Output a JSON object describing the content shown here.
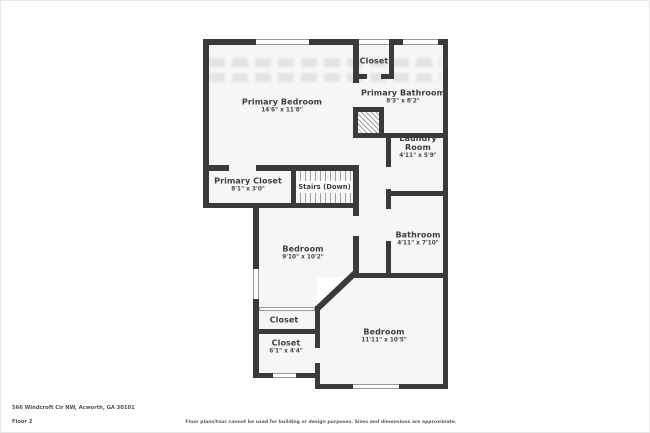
{
  "address_line": "566 Windcroft Cir NW, Acworth, GA 30101",
  "floor_label": "Floor 2",
  "disclaimer": "Floor plans/tour cannot be used for building or design purposes. Sizes and dimensions are approximate.",
  "colors": {
    "wall": "#3a3a3a",
    "room_fill": "#f6f6f6",
    "label_text": "#3d3d3d"
  },
  "rooms": {
    "primary_bedroom": {
      "name": "Primary Bedroom",
      "dims": "14'6\" x 11'8\""
    },
    "closet_top": {
      "name": "Closet"
    },
    "primary_bathroom": {
      "name": "Primary Bathroom",
      "dims": "8'3\" x 8'2\""
    },
    "primary_closet": {
      "name": "Primary Closet",
      "dims": "8'1\" x 3'0\""
    },
    "stairs": {
      "name": "Stairs (Down)"
    },
    "laundry": {
      "name": "Laundry Room",
      "dims": "4'11\" x 5'9\""
    },
    "bathroom": {
      "name": "Bathroom",
      "dims": "4'11\" x 7'10\""
    },
    "bedroom_mid": {
      "name": "Bedroom",
      "dims": "9'10\" x 10'2\""
    },
    "closet_mid": {
      "name": "Closet"
    },
    "closet_lower": {
      "name": "Closet",
      "dims": "6'1\" x 4'4\""
    },
    "bedroom_lower": {
      "name": "Bedroom",
      "dims": "11'11\" x 10'5\""
    }
  }
}
